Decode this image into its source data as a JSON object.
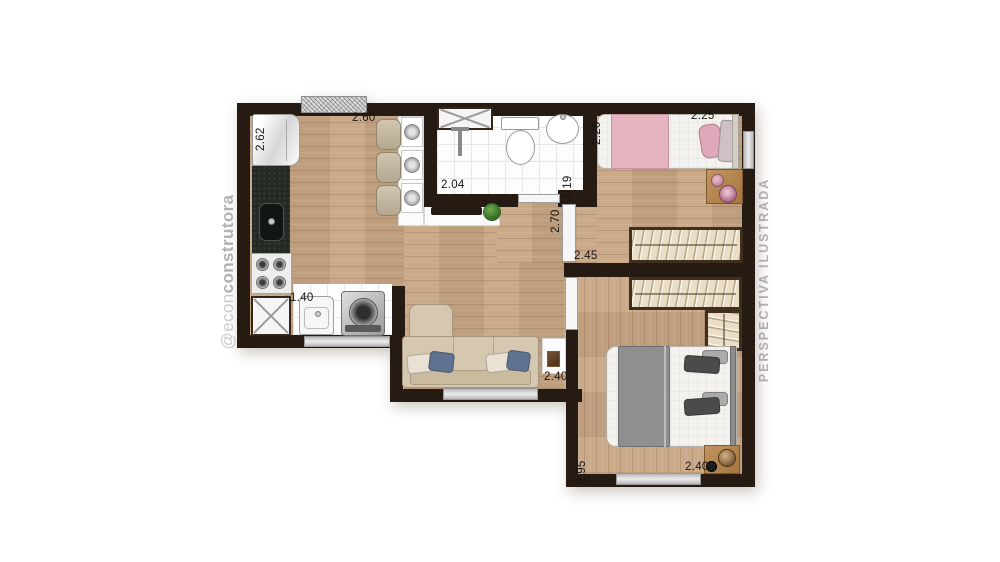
{
  "watermarks": {
    "left_prefix": "@econ",
    "left_bold": "construtora",
    "right": "PERSPECTIVA ILUSTRADA"
  },
  "dimensions": {
    "fridge_recess": "2.62",
    "kitchen": "2.60",
    "bathroom": "2.04",
    "bathroom_nook": "1.19",
    "bedroom1_depth": "2.20",
    "bedroom1_width": "2.25",
    "hallway": "2.70",
    "bedroom2_wall": "2.45",
    "laundry": "1.40",
    "living": "2.40",
    "bedroom2_depth": "2.95",
    "bedroom2_width": "2.40"
  },
  "colors": {
    "wall": "#261b12",
    "wood_floor": "#c7a583",
    "tile_floor": "#fdfdfd",
    "window": "#c6c6c6",
    "closet": "#eadfc6",
    "sofa": "#d5c7b0",
    "bed1_blanket": "#e5b4c1",
    "bed2_blanket": "#8f8f8f",
    "plant": "#3c7a2b",
    "watermark": "#b6b6b6"
  }
}
